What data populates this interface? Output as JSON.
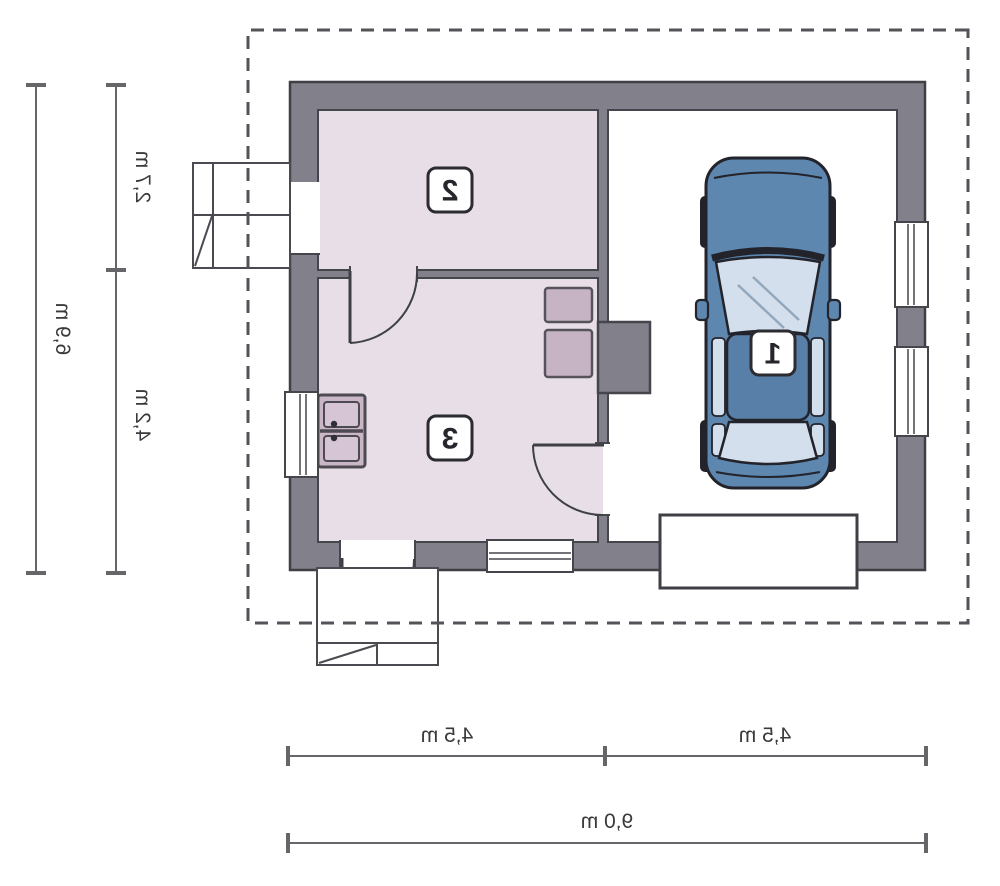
{
  "title": "Garage floor plan",
  "rooms": [
    {
      "number": "1",
      "type": "garage"
    },
    {
      "number": "2",
      "type": "room"
    },
    {
      "number": "3",
      "type": "room"
    }
  ],
  "dimensions": {
    "side": {
      "total": "6,9 m",
      "segments": [
        "2,7 m",
        "4,2 m"
      ]
    },
    "bottom": {
      "total": "9,0 m",
      "segments": [
        "4,5 m",
        "4,5 m"
      ]
    }
  },
  "colors": {
    "wall": "#82808a",
    "room_floor": "#e7dee7",
    "garage_floor": "#ffffff",
    "furniture_fill": "#c9b7c8",
    "car_body": "#5d87af",
    "car_glass": "#d3dfec",
    "outline": "#3f3f46",
    "dashed_eaves": "#53535a",
    "dimension_line": "#66666a"
  },
  "note_mirrored": "plan is rendered horizontally mirrored"
}
